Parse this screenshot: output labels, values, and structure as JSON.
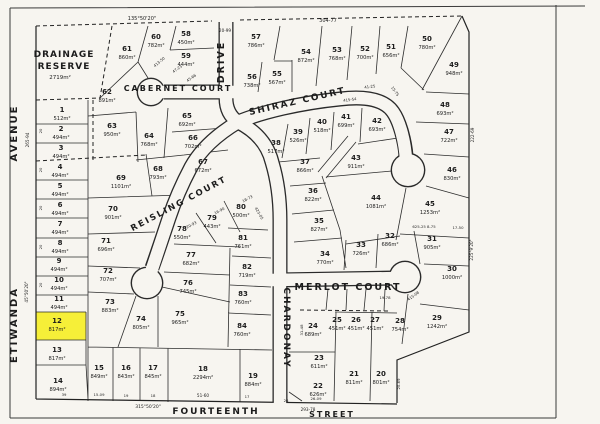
{
  "canvas": {
    "paper": "#f7f5f0",
    "ink": "#1f1f1f",
    "highlight_fill": "#f6ef38"
  },
  "reserve": {
    "line1": "DRAINAGE",
    "line2": "RESERVE",
    "area": "2719m²"
  },
  "highlight": {
    "lot": "12"
  },
  "streets": [
    {
      "t": "AVENUE",
      "x": 17,
      "y": 133,
      "r": -90,
      "s": 10,
      "ls": 3
    },
    {
      "t": "ETIWANDA",
      "x": 17,
      "y": 325,
      "r": -90,
      "s": 10,
      "ls": 3
    },
    {
      "t": "DRIVE",
      "x": 224,
      "y": 62,
      "r": -90,
      "s": 9.5,
      "ls": 2
    },
    {
      "t": "CABERNET COURT",
      "x": 178,
      "y": 91,
      "r": 0,
      "s": 8,
      "ls": 0.5
    },
    {
      "t": "SHIRAZ  COURT",
      "x": 298,
      "y": 104,
      "r": -13,
      "s": 9,
      "ls": 2
    },
    {
      "t": "REISLING COURT",
      "x": 180,
      "y": 206,
      "r": -28,
      "s": 8.5,
      "ls": 1.5
    },
    {
      "t": "CHARDONAY",
      "x": 284,
      "y": 328,
      "r": 90,
      "s": 9,
      "ls": 1
    },
    {
      "t": "MERLOT  COURT",
      "x": 348,
      "y": 290,
      "r": 0,
      "s": 9.5,
      "ls": 2
    },
    {
      "t": "FOURTEENTH",
      "x": 216,
      "y": 414,
      "r": 0,
      "s": 9,
      "ls": 3
    },
    {
      "t": "STREET",
      "x": 332,
      "y": 417,
      "r": 0,
      "s": 8,
      "ls": 2
    }
  ],
  "lots": [
    {
      "n": "1",
      "a": "512m²",
      "x": 62,
      "y": 112
    },
    {
      "n": "2",
      "a": "494m²",
      "x": 61,
      "y": 131
    },
    {
      "n": "3",
      "a": "494m²",
      "x": 61,
      "y": 150
    },
    {
      "n": "4",
      "a": "494m²",
      "x": 60,
      "y": 169
    },
    {
      "n": "5",
      "a": "494m²",
      "x": 60,
      "y": 188
    },
    {
      "n": "6",
      "a": "494m²",
      "x": 60,
      "y": 207
    },
    {
      "n": "7",
      "a": "494m²",
      "x": 60,
      "y": 226
    },
    {
      "n": "8",
      "a": "494m²",
      "x": 60,
      "y": 245
    },
    {
      "n": "9",
      "a": "494m²",
      "x": 59,
      "y": 263
    },
    {
      "n": "10",
      "a": "494m²",
      "x": 59,
      "y": 282
    },
    {
      "n": "11",
      "a": "494m²",
      "x": 59,
      "y": 301
    },
    {
      "n": "12",
      "a": "817m²",
      "x": 57,
      "y": 323
    },
    {
      "n": "13",
      "a": "817m²",
      "x": 57,
      "y": 352
    },
    {
      "n": "14",
      "a": "894m²",
      "x": 58,
      "y": 383
    },
    {
      "n": "15",
      "a": "849m²",
      "x": 99,
      "y": 370
    },
    {
      "n": "16",
      "a": "843m²",
      "x": 126,
      "y": 370
    },
    {
      "n": "17",
      "a": "845m²",
      "x": 153,
      "y": 370
    },
    {
      "n": "18",
      "a": "2294m²",
      "x": 203,
      "y": 371
    },
    {
      "n": "19",
      "a": "884m²",
      "x": 253,
      "y": 378
    },
    {
      "n": "20",
      "a": "801m²",
      "x": 381,
      "y": 376
    },
    {
      "n": "21",
      "a": "811m²",
      "x": 354,
      "y": 376
    },
    {
      "n": "22",
      "a": "626m²",
      "x": 318,
      "y": 388
    },
    {
      "n": "23",
      "a": "611m²",
      "x": 319,
      "y": 360
    },
    {
      "n": "24",
      "a": "689m²",
      "x": 313,
      "y": 328
    },
    {
      "n": "25",
      "a": "451m²",
      "x": 337,
      "y": 322
    },
    {
      "n": "26",
      "a": "451m²",
      "x": 356,
      "y": 322
    },
    {
      "n": "27",
      "a": "451m²",
      "x": 375,
      "y": 322
    },
    {
      "n": "28",
      "a": "754m²",
      "x": 400,
      "y": 323
    },
    {
      "n": "29",
      "a": "1242m²",
      "x": 437,
      "y": 320
    },
    {
      "n": "30",
      "a": "1000m²",
      "x": 452,
      "y": 271
    },
    {
      "n": "31",
      "a": "905m²",
      "x": 432,
      "y": 241
    },
    {
      "n": "32",
      "a": "686m²",
      "x": 390,
      "y": 238
    },
    {
      "n": "33",
      "a": "726m²",
      "x": 361,
      "y": 247
    },
    {
      "n": "34",
      "a": "770m²",
      "x": 325,
      "y": 256
    },
    {
      "n": "35",
      "a": "827m²",
      "x": 319,
      "y": 223
    },
    {
      "n": "36",
      "a": "822m²",
      "x": 313,
      "y": 193
    },
    {
      "n": "37",
      "a": "866m²",
      "x": 305,
      "y": 164
    },
    {
      "n": "38",
      "a": "517m²",
      "x": 276,
      "y": 145
    },
    {
      "n": "39",
      "a": "526m²",
      "x": 298,
      "y": 134
    },
    {
      "n": "40",
      "a": "518m²",
      "x": 322,
      "y": 124
    },
    {
      "n": "41",
      "a": "699m²",
      "x": 346,
      "y": 119
    },
    {
      "n": "42",
      "a": "693m²",
      "x": 377,
      "y": 123
    },
    {
      "n": "43",
      "a": "911m²",
      "x": 356,
      "y": 160
    },
    {
      "n": "44",
      "a": "1081m²",
      "x": 376,
      "y": 200
    },
    {
      "n": "45",
      "a": "1253m²",
      "x": 430,
      "y": 206
    },
    {
      "n": "46",
      "a": "830m²",
      "x": 452,
      "y": 172
    },
    {
      "n": "47",
      "a": "722m²",
      "x": 449,
      "y": 134
    },
    {
      "n": "48",
      "a": "693m²",
      "x": 445,
      "y": 107
    },
    {
      "n": "49",
      "a": "948m²",
      "x": 454,
      "y": 67
    },
    {
      "n": "50",
      "a": "780m²",
      "x": 427,
      "y": 41
    },
    {
      "n": "51",
      "a": "656m²",
      "x": 391,
      "y": 49
    },
    {
      "n": "52",
      "a": "700m²",
      "x": 365,
      "y": 51
    },
    {
      "n": "53",
      "a": "768m²",
      "x": 337,
      "y": 52
    },
    {
      "n": "54",
      "a": "872m²",
      "x": 306,
      "y": 54
    },
    {
      "n": "55",
      "a": "567m²",
      "x": 277,
      "y": 76
    },
    {
      "n": "56",
      "a": "738m²",
      "x": 252,
      "y": 79
    },
    {
      "n": "57",
      "a": "786m²",
      "x": 256,
      "y": 39
    },
    {
      "n": "58",
      "a": "450m²",
      "x": 186,
      "y": 36
    },
    {
      "n": "59",
      "a": "444m²",
      "x": 186,
      "y": 58
    },
    {
      "n": "60",
      "a": "782m²",
      "x": 156,
      "y": 39
    },
    {
      "n": "61",
      "a": "860m²",
      "x": 127,
      "y": 51
    },
    {
      "n": "62",
      "a": "891m²",
      "x": 107,
      "y": 94
    },
    {
      "n": "63",
      "a": "950m²",
      "x": 112,
      "y": 128
    },
    {
      "n": "64",
      "a": "768m²",
      "x": 149,
      "y": 138
    },
    {
      "n": "65",
      "a": "692m²",
      "x": 187,
      "y": 118
    },
    {
      "n": "66",
      "a": "702m²",
      "x": 193,
      "y": 140
    },
    {
      "n": "67",
      "a": "672m²",
      "x": 203,
      "y": 164
    },
    {
      "n": "68",
      "a": "793m²",
      "x": 158,
      "y": 171
    },
    {
      "n": "69",
      "a": "1101m²",
      "x": 121,
      "y": 180
    },
    {
      "n": "70",
      "a": "901m²",
      "x": 113,
      "y": 211
    },
    {
      "n": "71",
      "a": "696m²",
      "x": 106,
      "y": 243
    },
    {
      "n": "72",
      "a": "707m²",
      "x": 108,
      "y": 273
    },
    {
      "n": "73",
      "a": "883m²",
      "x": 110,
      "y": 304
    },
    {
      "n": "74",
      "a": "805m²",
      "x": 141,
      "y": 321
    },
    {
      "n": "75",
      "a": "965m²",
      "x": 180,
      "y": 316
    },
    {
      "n": "76",
      "a": "745m²",
      "x": 188,
      "y": 285
    },
    {
      "n": "77",
      "a": "682m²",
      "x": 191,
      "y": 257
    },
    {
      "n": "78",
      "a": "550m²",
      "x": 182,
      "y": 231
    },
    {
      "n": "79",
      "a": "443m²",
      "x": 212,
      "y": 220
    },
    {
      "n": "80",
      "a": "500m²",
      "x": 241,
      "y": 209
    },
    {
      "n": "81",
      "a": "761m²",
      "x": 243,
      "y": 240
    },
    {
      "n": "82",
      "a": "719m²",
      "x": 247,
      "y": 269
    },
    {
      "n": "83",
      "a": "760m²",
      "x": 243,
      "y": 296
    },
    {
      "n": "84",
      "a": "760m²",
      "x": 242,
      "y": 328
    }
  ],
  "dims": [
    {
      "t": "135°50'20\"",
      "x": 142,
      "y": 20,
      "r": 0,
      "s": 5
    },
    {
      "t": "20-99",
      "x": 225,
      "y": 32,
      "r": 0,
      "s": 4.2
    },
    {
      "t": "304-77",
      "x": 328,
      "y": 22,
      "r": 0,
      "s": 5
    },
    {
      "t": "265-94",
      "x": 29,
      "y": 140,
      "r": -90,
      "s": 4.2
    },
    {
      "t": "45°50'20\"",
      "x": 28,
      "y": 292,
      "r": -90,
      "s": 4.2
    },
    {
      "t": "222-69",
      "x": 474,
      "y": 135,
      "r": -90,
      "s": 4.2
    },
    {
      "t": "225°9'20\"",
      "x": 473,
      "y": 250,
      "r": -90,
      "s": 4.2
    },
    {
      "t": "315°50'20\"",
      "x": 148,
      "y": 408,
      "r": 0,
      "s": 4.5
    },
    {
      "t": "51-60",
      "x": 203,
      "y": 397,
      "r": 0,
      "s": 4.2
    },
    {
      "t": "15-09",
      "x": 99,
      "y": 396,
      "r": 0,
      "s": 3.8
    },
    {
      "t": "19",
      "x": 126,
      "y": 397,
      "r": 0,
      "s": 3.8
    },
    {
      "t": "18",
      "x": 153,
      "y": 397,
      "r": 0,
      "s": 3.8
    },
    {
      "t": "39",
      "x": 64,
      "y": 396,
      "r": 0,
      "s": 3.8
    },
    {
      "t": "17",
      "x": 247,
      "y": 398,
      "r": 0,
      "s": 3.8
    },
    {
      "t": "26",
      "x": 286,
      "y": 402,
      "r": 0,
      "s": 3.8
    },
    {
      "t": "26-09",
      "x": 316,
      "y": 400,
      "r": 0,
      "s": 3.8
    },
    {
      "t": "293-78",
      "x": 308,
      "y": 411,
      "r": 0,
      "s": 4.2
    },
    {
      "t": "47-23",
      "x": 178,
      "y": 70,
      "r": -35,
      "s": 3.8
    },
    {
      "t": "45-66",
      "x": 192,
      "y": 79,
      "r": -35,
      "s": 3.8
    },
    {
      "t": "413-50",
      "x": 160,
      "y": 63,
      "r": -40,
      "s": 3.8
    },
    {
      "t": "415-54",
      "x": 350,
      "y": 101,
      "r": -8,
      "s": 3.8
    },
    {
      "t": "41-25",
      "x": 370,
      "y": 88,
      "r": -8,
      "s": 3.8
    },
    {
      "t": "15-75",
      "x": 394,
      "y": 92,
      "r": 55,
      "s": 3.8
    },
    {
      "t": "20-93",
      "x": 192,
      "y": 226,
      "r": -28,
      "s": 3.8
    },
    {
      "t": "16-90",
      "x": 220,
      "y": 212,
      "r": -28,
      "s": 3.8
    },
    {
      "t": "18-73",
      "x": 248,
      "y": 200,
      "r": -28,
      "s": 3.8
    },
    {
      "t": "423-05",
      "x": 258,
      "y": 214,
      "r": 60,
      "s": 3.8
    },
    {
      "t": "19-78",
      "x": 385,
      "y": 299,
      "r": 0,
      "s": 3.8
    },
    {
      "t": "415-08",
      "x": 414,
      "y": 297,
      "r": -35,
      "s": 3.8
    },
    {
      "t": "625-25  8-75",
      "x": 424,
      "y": 228,
      "r": 0,
      "s": 3.8
    },
    {
      "t": "17-50",
      "x": 458,
      "y": 229,
      "r": 0,
      "s": 3.8
    },
    {
      "t": "31-48",
      "x": 303,
      "y": 330,
      "r": -90,
      "s": 3.8
    },
    {
      "t": "20-69",
      "x": 400,
      "y": 384,
      "r": -90,
      "s": 3.8
    },
    {
      "t": "20",
      "x": 42,
      "y": 131,
      "r": -90,
      "s": 3.8
    },
    {
      "t": "20",
      "x": 42,
      "y": 170,
      "r": -90,
      "s": 3.8
    },
    {
      "t": "20",
      "x": 42,
      "y": 208,
      "r": -90,
      "s": 3.8
    },
    {
      "t": "20",
      "x": 42,
      "y": 247,
      "r": -90,
      "s": 3.8
    },
    {
      "t": "20",
      "x": 42,
      "y": 285,
      "r": -90,
      "s": 3.8
    }
  ]
}
